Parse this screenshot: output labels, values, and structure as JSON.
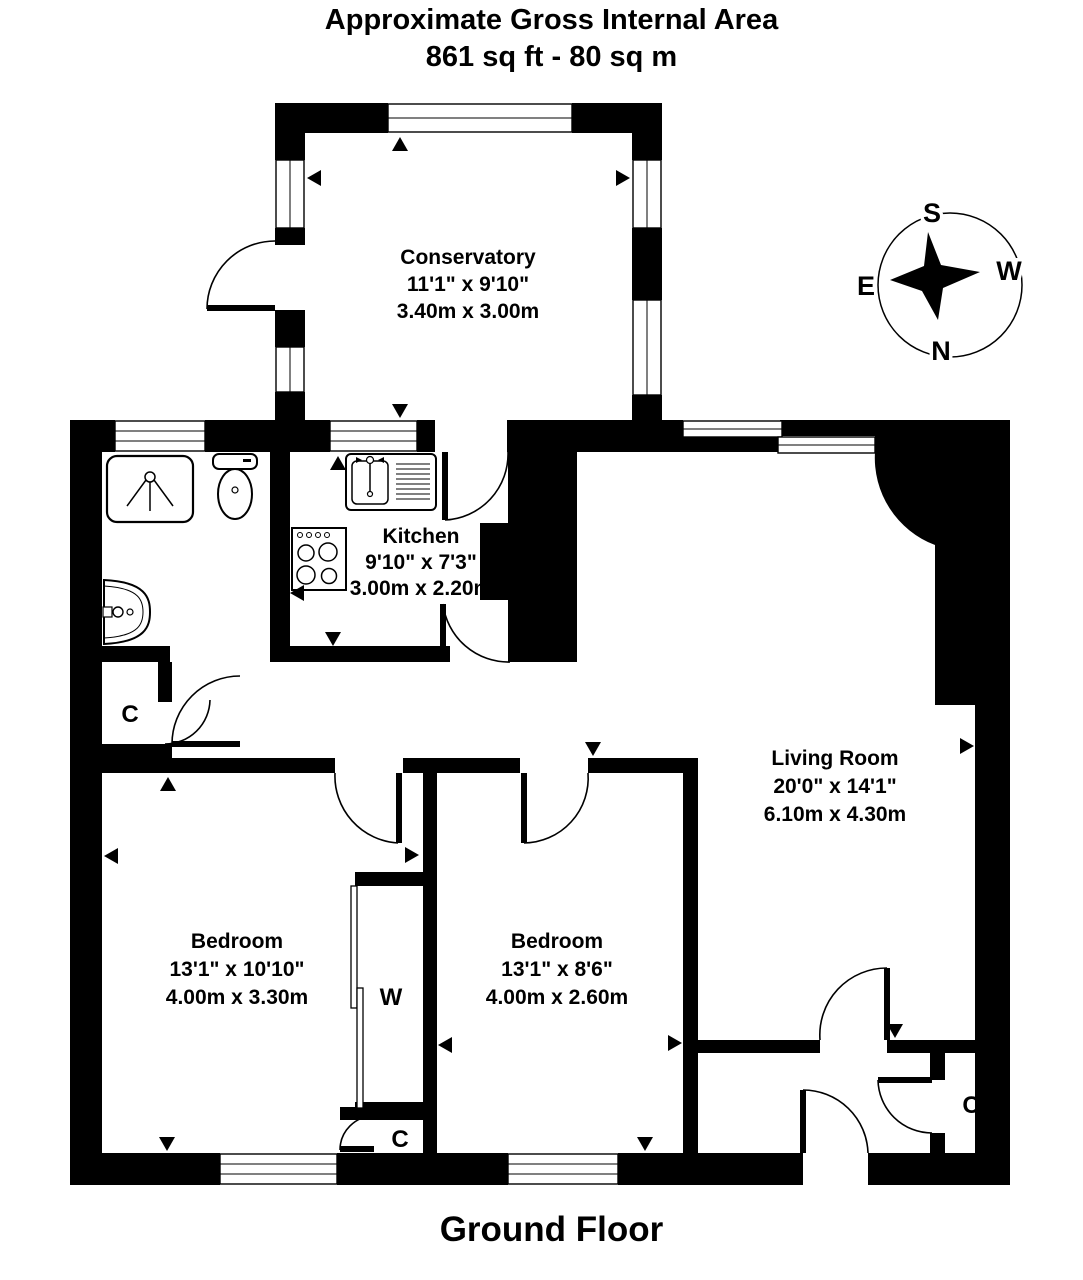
{
  "title": {
    "line1": "Approximate Gross Internal Area",
    "line2": "861 sq ft - 80 sq m"
  },
  "floor_label": "Ground Floor",
  "compass": {
    "north": "N",
    "south": "S",
    "east": "E",
    "west": "W"
  },
  "rooms": {
    "conservatory": {
      "name": "Conservatory",
      "imperial": "11'1\" x 9'10\"",
      "metric": "3.40m x 3.00m"
    },
    "kitchen": {
      "name": "Kitchen",
      "imperial": "9'10\" x 7'3\"",
      "metric": "3.00m x 2.20m"
    },
    "living_room": {
      "name": "Living Room",
      "imperial": "20'0\" x 14'1\"",
      "metric": "6.10m x 4.30m"
    },
    "bedroom_left": {
      "name": "Bedroom",
      "imperial": "13'1\" x 10'10\"",
      "metric": "4.00m x 3.30m"
    },
    "bedroom_right": {
      "name": "Bedroom",
      "imperial": "13'1\" x 8'6\"",
      "metric": "4.00m x 2.60m"
    }
  },
  "closets": {
    "hall": "C",
    "wardrobe": "W",
    "bedroom": "C",
    "entrance": "C"
  },
  "colors": {
    "wall": "#000000",
    "background": "#ffffff"
  }
}
